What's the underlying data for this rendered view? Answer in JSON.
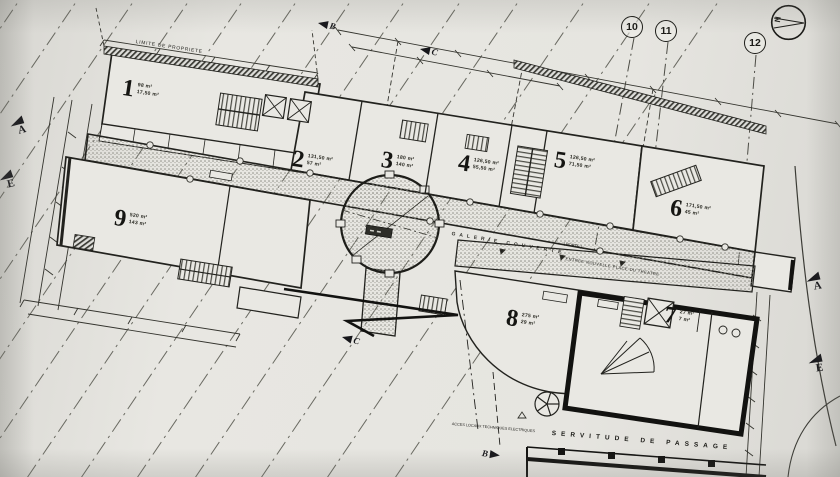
{
  "palette": {
    "paper": "#e4e3df",
    "ink": "#1b1b18"
  },
  "drawing": {
    "north": "N",
    "boundary_note": "LIMITE DE PROPRIETE",
    "gallery_label": "GALERIE COUVERTE",
    "porte_note": "( PORTE )",
    "entrance_note": "ENTREE NOUVELLE PLACE DU THEATRE",
    "servitude_note": "SERVITUDE DE PASSAGE",
    "access_note": "ACCES LOCAUX TECHNIQUES ELECTRIQUES"
  },
  "rooms": [
    {
      "number": "1",
      "area1": "98 m²",
      "area2": "17,50 m²"
    },
    {
      "number": "2",
      "area1": "131,50 m²",
      "area2": "57 m²"
    },
    {
      "number": "3",
      "area1": "180 m²",
      "area2": "140 m²"
    },
    {
      "number": "4",
      "area1": "126,50 m²",
      "area2": "55,50 m²"
    },
    {
      "number": "5",
      "area1": "126,50 m²",
      "area2": "71,50 m²"
    },
    {
      "number": "6",
      "area1": "171,50 m²",
      "area2": "45 m²"
    },
    {
      "number": "7",
      "area1": "27 m²",
      "area2": "7 m²"
    },
    {
      "number": "8",
      "area1": "275 m²",
      "area2": "29 m²"
    },
    {
      "number": "9",
      "area1": "520 m²",
      "area2": "143 m²"
    }
  ],
  "reference_points": [
    "10",
    "11",
    "12"
  ],
  "section_marks": {
    "left": [
      "A",
      "E"
    ],
    "right": [
      "A",
      "E"
    ],
    "top": [
      "B",
      "C"
    ],
    "bottom": [
      "C",
      "B"
    ]
  }
}
